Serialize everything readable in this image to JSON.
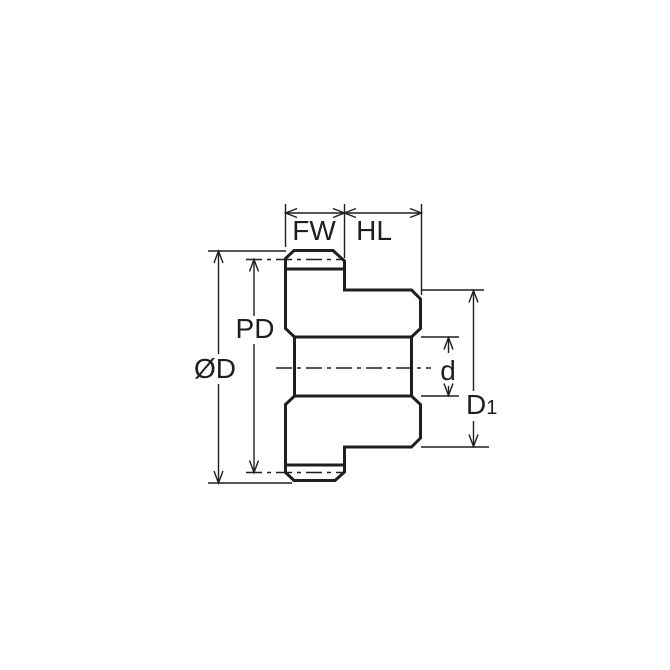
{
  "diagram": {
    "colors": {
      "section_fill": "#c6e6f8",
      "line": "#1f1f1f",
      "background": "#ffffff"
    },
    "labels": {
      "face_width": "FW",
      "hub_length": "HL",
      "pitch_diameter": "PD",
      "outside_diameter": "ØD",
      "bore_diameter": "d",
      "hub_diameter_main": "D",
      "hub_diameter_sub": "1"
    }
  }
}
